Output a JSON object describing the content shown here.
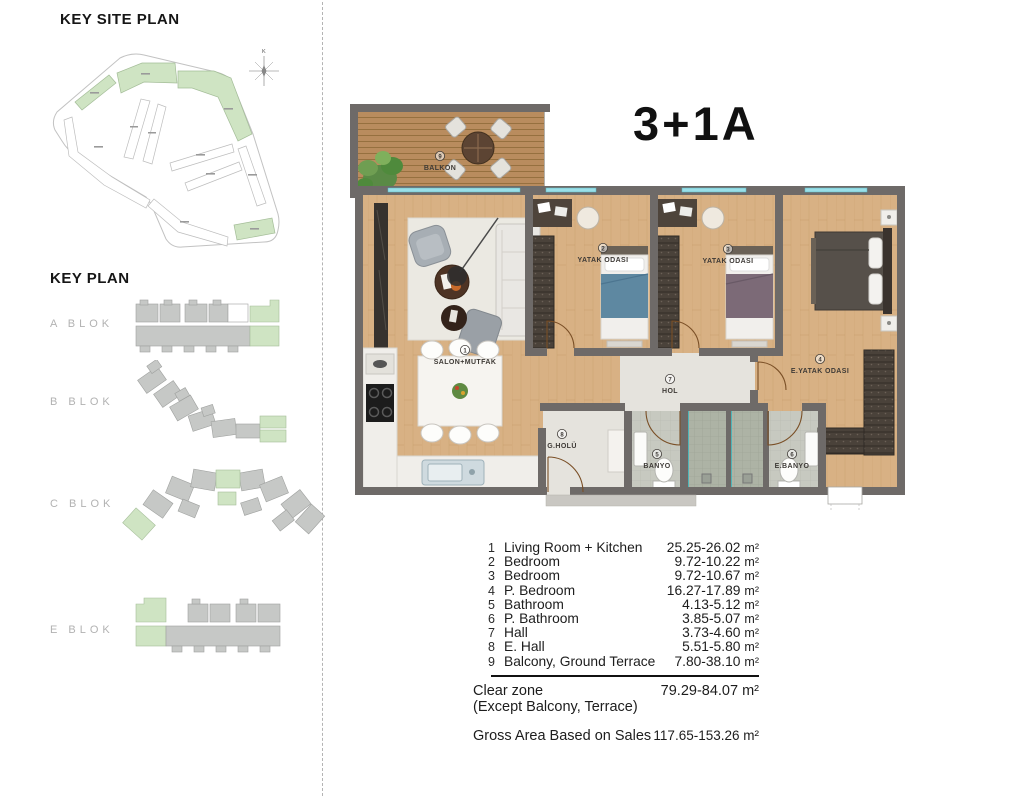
{
  "left_panel": {
    "site_plan_heading": "KEY SITE PLAN",
    "key_plan_heading": "KEY PLAN",
    "compass_label": "K",
    "blocks": [
      {
        "label": "A BLOK"
      },
      {
        "label": "B BLOK"
      },
      {
        "label": "C BLOK"
      },
      {
        "label": "E BLOK"
      }
    ]
  },
  "plan": {
    "unit_title": "3+1A",
    "rooms": [
      {
        "num": "1",
        "label": "SALON+MUTFAK"
      },
      {
        "num": "2",
        "label": "YATAK ODASI"
      },
      {
        "num": "3",
        "label": "YATAK ODASI"
      },
      {
        "num": "4",
        "label": "E.YATAK ODASI"
      },
      {
        "num": "5",
        "label": "BANYO"
      },
      {
        "num": "6",
        "label": "E.BANYO"
      },
      {
        "num": "7",
        "label": "HOL"
      },
      {
        "num": "8",
        "label": "G.HOLÜ"
      },
      {
        "num": "9",
        "label": "BALKON"
      }
    ]
  },
  "legend": {
    "rows": [
      {
        "num": "1",
        "label": "Living Room + Kitchen",
        "value": "25.25-26.02",
        "unit": "m²"
      },
      {
        "num": "2",
        "label": "Bedroom",
        "value": "9.72-10.22",
        "unit": "m²"
      },
      {
        "num": "3",
        "label": "Bedroom",
        "value": "9.72-10.67",
        "unit": "m²"
      },
      {
        "num": "4",
        "label": "P. Bedroom",
        "value": "16.27-17.89",
        "unit": "m²"
      },
      {
        "num": "5",
        "label": "Bathroom",
        "value": "4.13-5.12",
        "unit": "m²"
      },
      {
        "num": "6",
        "label": "P. Bathroom",
        "value": "3.85-5.07",
        "unit": "m²"
      },
      {
        "num": "7",
        "label": "Hall",
        "value": "3.73-4.60",
        "unit": "m²"
      },
      {
        "num": "8",
        "label": "E. Hall",
        "value": "5.51-5.80",
        "unit": "m²"
      },
      {
        "num": "9",
        "label": "Balcony, Ground Terrace",
        "value": "7.80-38.10",
        "unit": "m²"
      }
    ],
    "clear_zone": {
      "label": "Clear zone",
      "sub": "(Except Balcony, Terrace)",
      "value": "79.29-84.07 m²"
    },
    "gross": {
      "label": "Gross Area Based on Sales",
      "value": "117.65-153.26 m²"
    }
  },
  "colors": {
    "wall": "#6e6a68",
    "wood_floor": "#d8b184",
    "deck": "#b98c5e",
    "tile": "#c7c9c0",
    "shower_tile": "#adb3a5",
    "highlight_green": "#cfe4c3",
    "keyplan_gray": "#c6c8c6",
    "window_glass": "#9adfe8",
    "shower_glass": "#37b6bd"
  }
}
